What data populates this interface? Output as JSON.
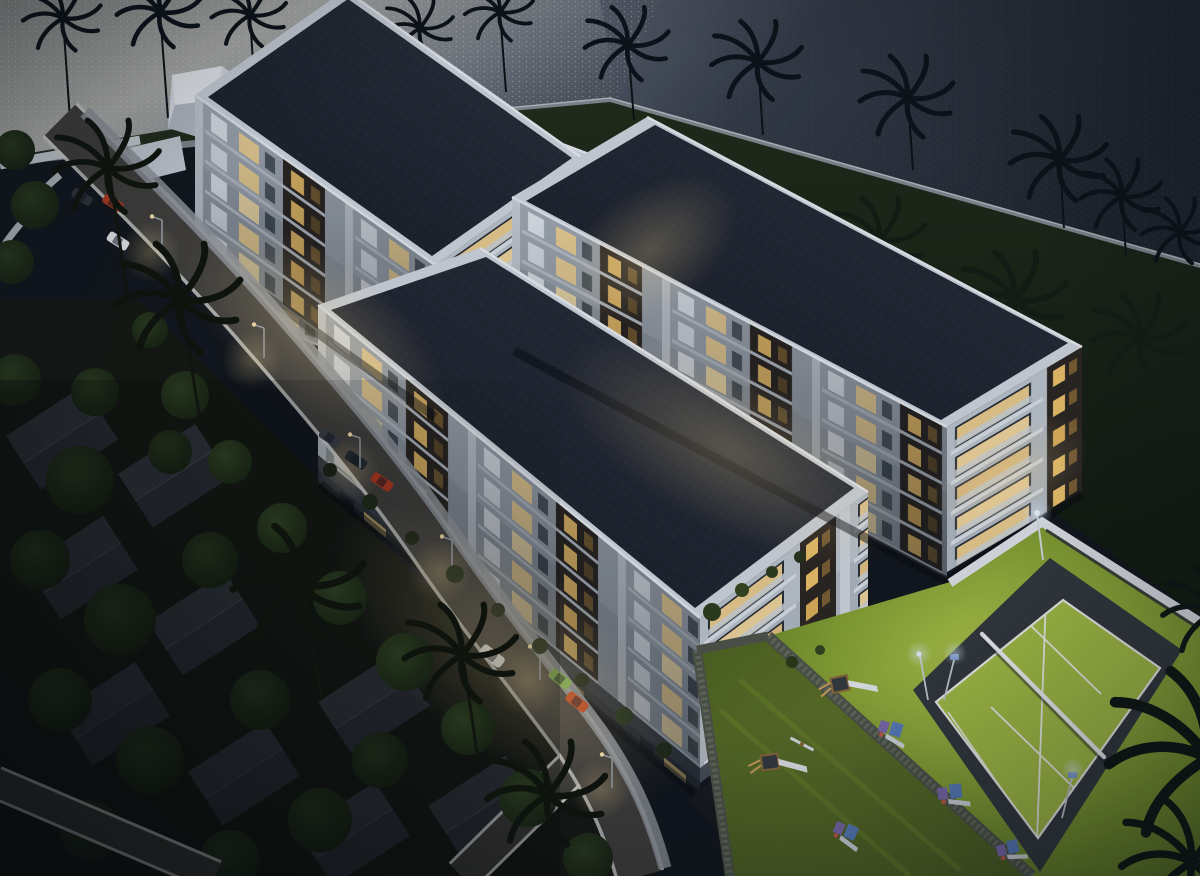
{
  "scene": {
    "title": "Aerial dusk rendering of a gated residential estate",
    "description": "3D architectural visualization viewed from above at dusk: four long flat-roofed apartment blocks with warmly lit balconies arranged in a pinwheel, an access road with cars and street lamps, a walled compound beside a palm-lined waterfront, a floodlit tennis court and children's playground on a bright lawn, and a dark tree-filled villa neighborhood in the foreground",
    "time_of_day": "dusk",
    "buildings": {
      "count": 4,
      "storeys_visible": 5,
      "roof_style": "flat dark membrane with white parapet",
      "facade_style": "white walls, dark timber panels, warm lit balconies"
    },
    "amenities": [
      "tennis court",
      "children playground",
      "bright lawn",
      "gabion fence",
      "floodlights"
    ],
    "environment": [
      "waterfront",
      "palm trees",
      "access road",
      "street lamps",
      "villa rooftops",
      "dense trees",
      "white boundary wall",
      "gatehouse"
    ],
    "vehicles": {
      "count": 9,
      "colors": [
        "white",
        "red",
        "green",
        "dark-grey"
      ]
    }
  },
  "palette": {
    "water-left-hi": "#b4b5b0",
    "water-left-lo": "#4a515c",
    "water-right-hi": "#59606c",
    "water-right-lo": "#1f242d",
    "shore-path": "#858a91",
    "grass-dark": "#1c2616",
    "grass-shore": "#232e1a",
    "lawn-bright": "#b9cf4e",
    "lawn-mid": "#7f9c2e",
    "lawn-deep": "#55711f",
    "play-grass": "#4d6120",
    "court-pad": "#33383d",
    "court-surface": "#a8c244",
    "court-line": "#f2f4ec",
    "roof-base": "#222733",
    "roof-dot": "#2c3240",
    "parapet": "#d3d9e0",
    "facade-wall": "#98a1ab",
    "facade-wall-bright": "#b3bbc5",
    "panel-dark": "#2b2520",
    "window-warm": "#f5d89a",
    "window-white": "#e7ecf2",
    "plinth": "#3e434a",
    "road": "#413f3c",
    "road-edge": "#d3d3d1",
    "sidewalk": "#92969d",
    "tree-dark": "#15200f",
    "tree-mid": "#2a3a1d",
    "palm-dark": "#0c1117",
    "house-roof": "#2b2e35",
    "fence": "#4e5348",
    "wall-white": "#e2e6ea",
    "car-red": "#b5391f",
    "car-green": "#7fae4e",
    "car-white": "#e9ebed",
    "car-dark": "#2e3238",
    "lamp-glow": "#ffdf9a",
    "night-tint": "#16202e"
  }
}
